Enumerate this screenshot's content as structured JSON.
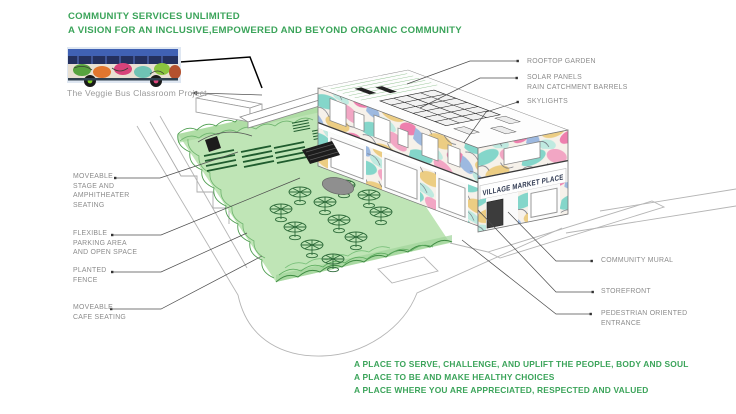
{
  "header": {
    "title": "COMMUNITY SERVICES UNLIMITED",
    "subtitle": "A VISION FOR AN INCLUSIVE,EMPOWERED AND BEYOND ORGANIC COMMUNITY"
  },
  "veggie_bus": {
    "caption": "The Veggie Bus Classroom Project"
  },
  "callouts": {
    "left": [
      {
        "lines": [
          "MOVEABLE",
          "STAGE AND",
          "AMPHITHEATER",
          "SEATING"
        ]
      },
      {
        "lines": [
          "FLEXIBLE",
          "PARKING AREA",
          "AND OPEN SPACE"
        ]
      },
      {
        "lines": [
          "PLANTED",
          "FENCE"
        ]
      },
      {
        "lines": [
          "MOVEABLE",
          "CAFE SEATING"
        ]
      }
    ],
    "right": [
      {
        "lines": [
          "ROOFTOP GARDEN"
        ]
      },
      {
        "lines": [
          "SOLAR PANELS",
          "RAIN CATCHMENT BARRELS"
        ]
      },
      {
        "lines": [
          "SKYLIGHTS"
        ]
      },
      {
        "lines": [
          "COMMUNITY MURAL"
        ]
      },
      {
        "lines": [
          "STOREFRONT"
        ]
      },
      {
        "lines": [
          "PEDESTRIAN ORIENTED",
          "ENTRANCE"
        ]
      }
    ]
  },
  "building": {
    "sign": "VILLAGE MARKET PLACE"
  },
  "footer": {
    "lines": [
      "A PLACE TO SERVE, CHALLENGE, AND UPLIFT THE PEOPLE, BODY AND SOUL",
      "A PLACE TO BE AND MAKE HEALTHY CHOICES",
      "A PLACE WHERE YOU ARE APPRECIATED, RESPECTED AND VALUED"
    ]
  },
  "colors": {
    "accent_green": "#3ba45a",
    "label_gray": "#8c8c8c",
    "lawn_green": "#bfe5b6",
    "fence_green": "#4e9e50",
    "mural_pink": "#f2a6c4",
    "mural_teal": "#84d6ca",
    "mural_yellow": "#eccd83",
    "mural_blue": "#9db9e0"
  }
}
